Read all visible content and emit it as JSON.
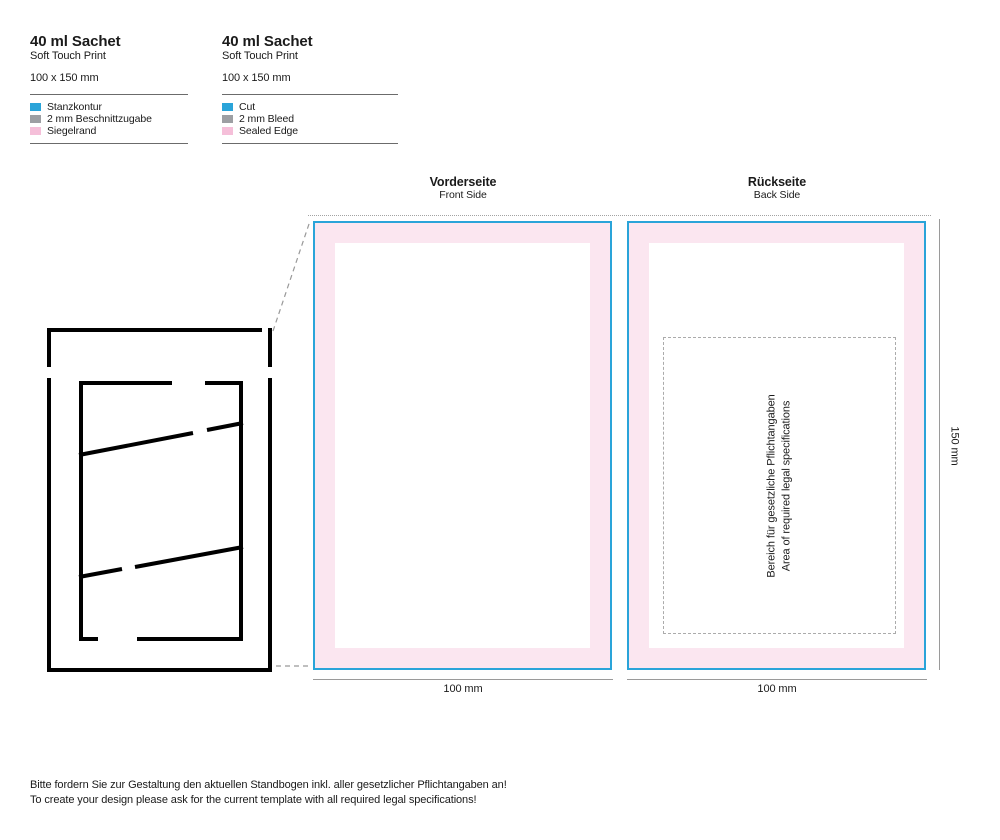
{
  "colors": {
    "cut_blue": "#2aa4d9",
    "bleed_gray": "#9d9fa3",
    "seal_pink": "#f5bfd9",
    "panel_seal_pink": "#fbe6f0"
  },
  "legend_de": {
    "title": "40 ml Sachet",
    "subtitle": "Soft Touch Print",
    "size": "100 x 150 mm",
    "items": [
      {
        "label": "Stanzkontur",
        "color": "#2aa4d9"
      },
      {
        "label": "2 mm Beschnittzugabe",
        "color": "#9d9fa3"
      },
      {
        "label": "Siegelrand",
        "color": "#f5bfd9"
      }
    ]
  },
  "legend_en": {
    "title": "40 ml Sachet",
    "subtitle": "Soft Touch Print",
    "size": "100 x 150 mm",
    "items": [
      {
        "label": "Cut",
        "color": "#2aa4d9"
      },
      {
        "label": "2 mm Bleed",
        "color": "#9d9fa3"
      },
      {
        "label": "Sealed Edge",
        "color": "#f5bfd9"
      }
    ]
  },
  "front_panel": {
    "title": "Vorderseite",
    "subtitle": "Front Side",
    "width_label": "100 mm"
  },
  "back_panel": {
    "title": "Rückseite",
    "subtitle": "Back Side",
    "width_label": "100 mm",
    "legal_area": {
      "line_de": "Bereich für gesetzliche Pflichtangaben",
      "line_en": "Area of required legal specifications"
    }
  },
  "height_label": "150 mm",
  "footer": {
    "line_de": "Bitte fordern Sie zur Gestaltung den aktuellen Standbogen inkl. aller gesetzlicher Pflichtangaben an!",
    "line_en": "To create your design please ask for the current template with all required legal specifications!"
  }
}
